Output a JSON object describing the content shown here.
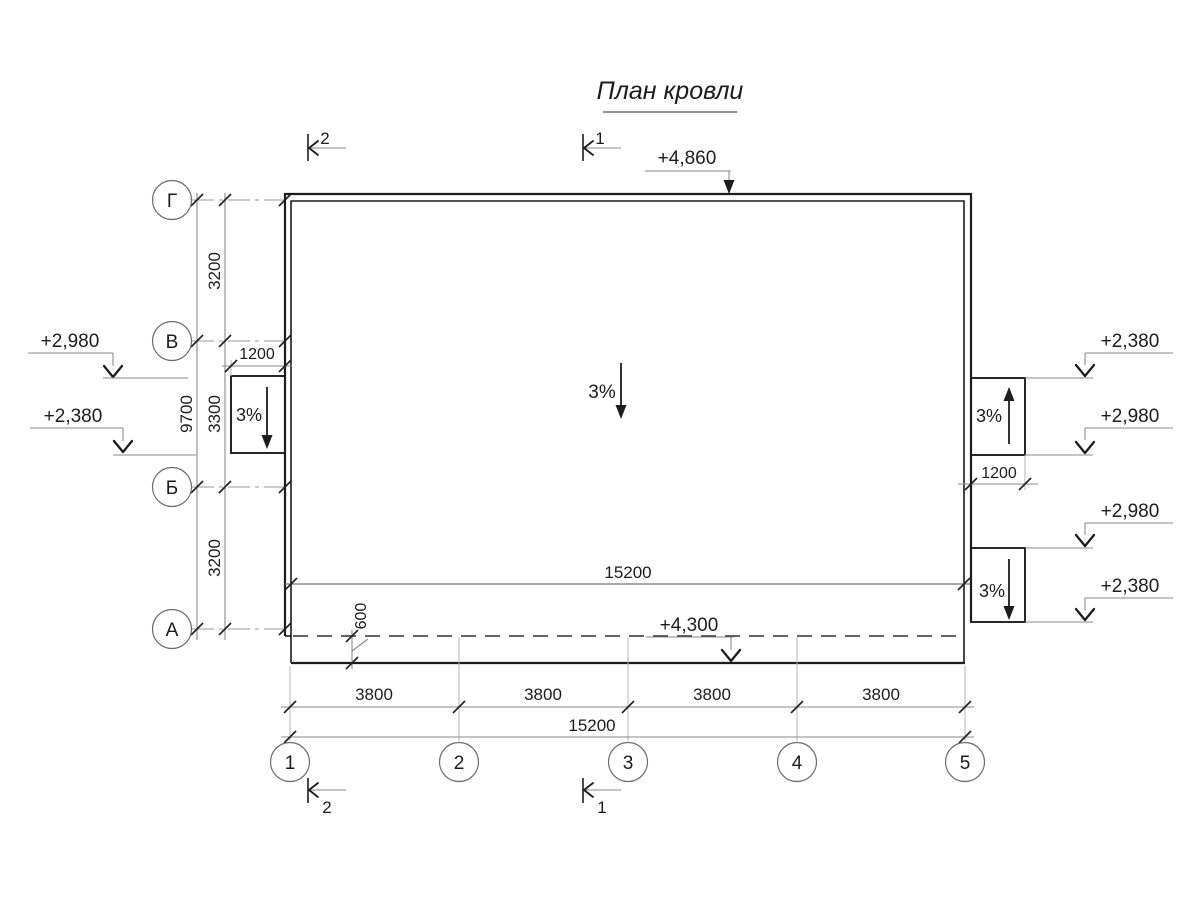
{
  "title": "План кровли",
  "row_axes": [
    {
      "label": "Г"
    },
    {
      "label": "В"
    },
    {
      "label": "Б"
    },
    {
      "label": "А"
    }
  ],
  "col_axes": [
    {
      "label": "1"
    },
    {
      "label": "2"
    },
    {
      "label": "3"
    },
    {
      "label": "4"
    },
    {
      "label": "5"
    }
  ],
  "dims": {
    "row_spacing": [
      "3200",
      "3300",
      "3200"
    ],
    "row_total": "9700",
    "left_ledge_width": "1200",
    "right_ledge_width": "1200",
    "col_spacing": [
      "3800",
      "3800",
      "3800",
      "3800"
    ],
    "col_total": "15200",
    "roof_width": "15200",
    "canopy_depth": "600"
  },
  "elevations": {
    "parapet_top": "+4,860",
    "canopy_edge": "+4,300",
    "left_upper": "+2,980",
    "left_lower": "+2,380",
    "right_top_ledge_high": "+2,380",
    "right_top_ledge_low": "+2,980",
    "right_bottom_ledge_high": "+2,980",
    "right_bottom_ledge_low": "+2,380"
  },
  "slopes": {
    "main": "3%",
    "left_ledge": "3%",
    "right_top_ledge": "3%",
    "right_bottom_ledge": "3%"
  },
  "sections": {
    "top_left": "2",
    "top_center": "1",
    "bottom_left": "2",
    "bottom_center": "1"
  },
  "colors": {
    "background": "#ffffff",
    "ink": "#1c1c1c",
    "dim_line": "#8a8a8a",
    "ext_line": "#b5b5b5"
  }
}
